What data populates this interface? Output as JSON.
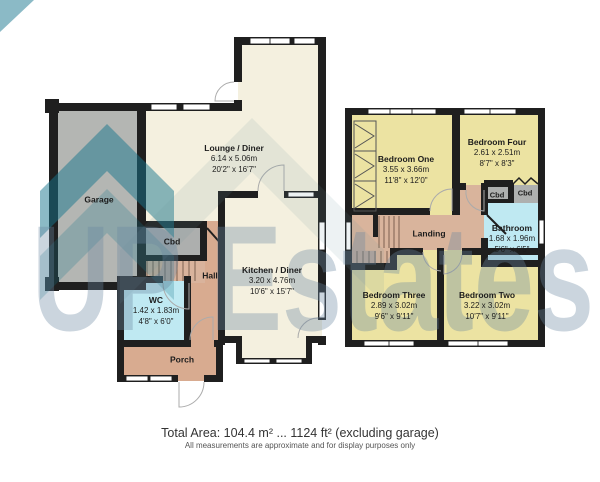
{
  "watermark": {
    "brand": "UP Estates"
  },
  "footer": {
    "total_area": "Total Area: 104.4 m² ... 1124 ft² (excluding garage)",
    "disclaimer": "All measurements are approximate and for display purposes only"
  },
  "ground_floor": {
    "garage": {
      "name": "Garage"
    },
    "lounge": {
      "name": "Lounge / Diner",
      "metric": "6.14 x 5.06m",
      "imperial": "20'2\" x 16'7\""
    },
    "kitchen": {
      "name": "Kitchen / Diner",
      "metric": "3.20 x 4.76m",
      "imperial": "10'6\" x 15'7\""
    },
    "cbd": {
      "name": "Cbd"
    },
    "hall": {
      "name": "Hall"
    },
    "wc": {
      "name": "WC",
      "metric": "1.42 x 1.83m",
      "imperial": "4'8\" x 6'0\""
    },
    "porch": {
      "name": "Porch"
    }
  },
  "first_floor": {
    "bedroom_one": {
      "name": "Bedroom One",
      "metric": "3.55 x 3.66m",
      "imperial": "11'8\" x 12'0\""
    },
    "bedroom_four": {
      "name": "Bedroom Four",
      "metric": "2.61 x 2.51m",
      "imperial": "8'7\" x 8'3\""
    },
    "bedroom_three": {
      "name": "Bedroom Three",
      "metric": "2.89 x 3.02m",
      "imperial": "9'6\" x 9'11\""
    },
    "bedroom_two": {
      "name": "Bedroom Two",
      "metric": "3.22 x 3.02m",
      "imperial": "10'7\" x 9'11\""
    },
    "bathroom": {
      "name": "Bathroom",
      "metric": "1.68 x 1.96m",
      "imperial": "5'6\" x 6'5\""
    },
    "landing": {
      "name": "Landing"
    },
    "cbd_left": {
      "name": "Cbd"
    },
    "cbd_right": {
      "name": "Cbd"
    }
  },
  "colors": {
    "wall": "#1f1f1f",
    "room_cream": "#f4f0df",
    "room_yellow": "#ece3a2",
    "room_tan": "#d8ab90",
    "room_cyan": "#bfe9f2",
    "room_grey": "#b4b6b3",
    "watermark_teal": "#17768d",
    "watermark_text": "#9bb3c6"
  }
}
